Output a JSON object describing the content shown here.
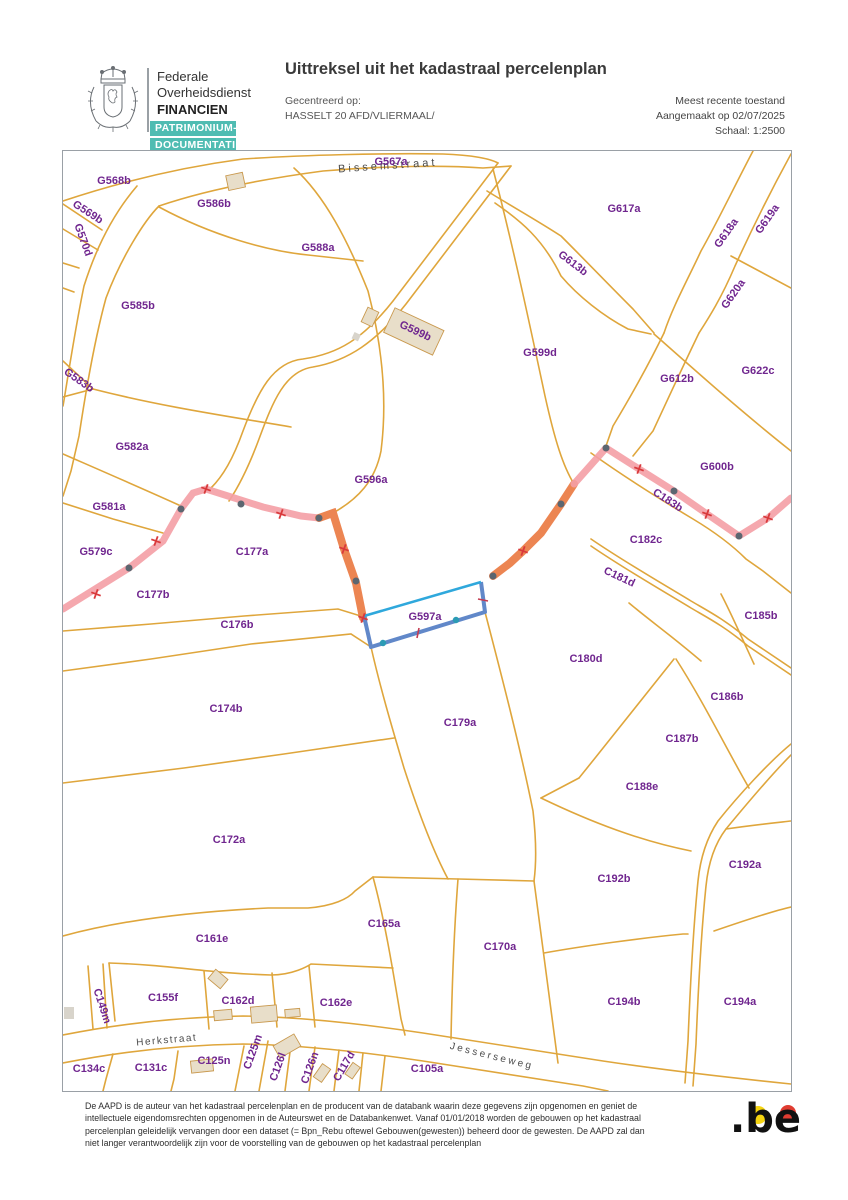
{
  "header": {
    "org_line1": "Federale",
    "org_line2": "Overheidsdienst",
    "org_line3": "FINANCIEN",
    "badge_line1": "PATRIMONIUM-",
    "badge_line2": "DOCUMENTATIE",
    "title": "Uittreksel uit het kadastraal percelenplan",
    "centered_label": "Gecentreerd op:",
    "centered_value": "HASSELT 20 AFD/VLIERMAAL/",
    "status": "Meest recente toestand",
    "created": "Aangemaakt op 02/07/2025",
    "scale": "Schaal: 1:2500"
  },
  "map": {
    "selected_parcel": "G597a",
    "colors": {
      "parcel_line": "#dfa63c",
      "parcel_label": "#70268f",
      "municipal_boundary": "#f49fa5",
      "selected_boundary": "#ec8552",
      "highlight_top": "#2fa8dc",
      "highlight_edge": "#6188c9",
      "building_fill": "#e8dec9",
      "marker_dot": "#5c6670",
      "marker_cross": "#d93a3c"
    },
    "streets": [
      {
        "name": "Bissemstraat",
        "x": 325,
        "y": 18,
        "rot": -4,
        "fs": 11,
        "ls": 3
      },
      {
        "name": "Herkstraat",
        "x": 104,
        "y": 892,
        "rot": -5,
        "fs": 10,
        "ls": 1.5
      },
      {
        "name": "Jesserseweg",
        "x": 428,
        "y": 908,
        "rot": 14,
        "fs": 10,
        "ls": 2.5
      }
    ],
    "parcels": [
      {
        "id": "G567a",
        "x": 328,
        "y": 14,
        "rot": 0
      },
      {
        "id": "G568b",
        "x": 51,
        "y": 33,
        "rot": 0
      },
      {
        "id": "G569b",
        "x": 23,
        "y": 64,
        "rot": 33
      },
      {
        "id": "G570d",
        "x": 17,
        "y": 90,
        "rot": 70
      },
      {
        "id": "G586b",
        "x": 151,
        "y": 56,
        "rot": 0
      },
      {
        "id": "G588a",
        "x": 255,
        "y": 100,
        "rot": 0
      },
      {
        "id": "G585b",
        "x": 75,
        "y": 158,
        "rot": 0
      },
      {
        "id": "G617a",
        "x": 561,
        "y": 61,
        "rot": 0
      },
      {
        "id": "G613b",
        "x": 508,
        "y": 115,
        "rot": 37
      },
      {
        "id": "G618a",
        "x": 666,
        "y": 84,
        "rot": -55
      },
      {
        "id": "G619a",
        "x": 707,
        "y": 70,
        "rot": -55
      },
      {
        "id": "G620a",
        "x": 673,
        "y": 145,
        "rot": -55
      },
      {
        "id": "G599b",
        "x": 351,
        "y": 183,
        "rot": 25
      },
      {
        "id": "G599d",
        "x": 477,
        "y": 205,
        "rot": 0
      },
      {
        "id": "G612b",
        "x": 614,
        "y": 231,
        "rot": 0
      },
      {
        "id": "G622c",
        "x": 695,
        "y": 223,
        "rot": 0
      },
      {
        "id": "G583b",
        "x": 14,
        "y": 232,
        "rot": 35
      },
      {
        "id": "G582a",
        "x": 69,
        "y": 299,
        "rot": 0
      },
      {
        "id": "G596a",
        "x": 308,
        "y": 332,
        "rot": 0
      },
      {
        "id": "G600b",
        "x": 654,
        "y": 319,
        "rot": 0
      },
      {
        "id": "C183b",
        "x": 603,
        "y": 352,
        "rot": 33
      },
      {
        "id": "G581a",
        "x": 46,
        "y": 359,
        "rot": 0
      },
      {
        "id": "C182c",
        "x": 583,
        "y": 392,
        "rot": 0
      },
      {
        "id": "G579c",
        "x": 33,
        "y": 404,
        "rot": 0
      },
      {
        "id": "C177a",
        "x": 189,
        "y": 404,
        "rot": 0
      },
      {
        "id": "C181d",
        "x": 555,
        "y": 429,
        "rot": 25
      },
      {
        "id": "C177b",
        "x": 90,
        "y": 447,
        "rot": 0
      },
      {
        "id": "C185b",
        "x": 698,
        "y": 468,
        "rot": 0
      },
      {
        "id": "G597a",
        "x": 362,
        "y": 469,
        "rot": 0
      },
      {
        "id": "C176b",
        "x": 174,
        "y": 477,
        "rot": 0
      },
      {
        "id": "C180d",
        "x": 523,
        "y": 511,
        "rot": 0
      },
      {
        "id": "C186b",
        "x": 664,
        "y": 549,
        "rot": 0
      },
      {
        "id": "C174b",
        "x": 163,
        "y": 561,
        "rot": 0
      },
      {
        "id": "C179a",
        "x": 397,
        "y": 575,
        "rot": 0
      },
      {
        "id": "C187b",
        "x": 619,
        "y": 591,
        "rot": 0
      },
      {
        "id": "C188e",
        "x": 579,
        "y": 639,
        "rot": 0
      },
      {
        "id": "C172a",
        "x": 166,
        "y": 692,
        "rot": 0
      },
      {
        "id": "C192b",
        "x": 551,
        "y": 731,
        "rot": 0
      },
      {
        "id": "C192a",
        "x": 682,
        "y": 717,
        "rot": 0
      },
      {
        "id": "C165a",
        "x": 321,
        "y": 776,
        "rot": 0
      },
      {
        "id": "C161e",
        "x": 149,
        "y": 791,
        "rot": 0
      },
      {
        "id": "C170a",
        "x": 437,
        "y": 799,
        "rot": 0
      },
      {
        "id": "C155f",
        "x": 100,
        "y": 850,
        "rot": 0
      },
      {
        "id": "C162d",
        "x": 175,
        "y": 853,
        "rot": 0
      },
      {
        "id": "C162e",
        "x": 273,
        "y": 855,
        "rot": 0
      },
      {
        "id": "C149m",
        "x": 36,
        "y": 856,
        "rot": 72
      },
      {
        "id": "C194b",
        "x": 561,
        "y": 854,
        "rot": 0
      },
      {
        "id": "C194a",
        "x": 677,
        "y": 854,
        "rot": 0
      },
      {
        "id": "C134c",
        "x": 26,
        "y": 921,
        "rot": 0
      },
      {
        "id": "C131c",
        "x": 88,
        "y": 920,
        "rot": 0
      },
      {
        "id": "C125n",
        "x": 151,
        "y": 913,
        "rot": 0
      },
      {
        "id": "C125m",
        "x": 193,
        "y": 902,
        "rot": -70
      },
      {
        "id": "C126l",
        "x": 218,
        "y": 917,
        "rot": -70
      },
      {
        "id": "C126n",
        "x": 250,
        "y": 918,
        "rot": -70
      },
      {
        "id": "C117d",
        "x": 284,
        "y": 917,
        "rot": -60
      },
      {
        "id": "C105a",
        "x": 364,
        "y": 921,
        "rot": 0
      }
    ]
  },
  "footer": {
    "disclaimer": "De AAPD is de auteur van het kadastraal percelenplan en de producent van de databank waarin deze gegevens zijn opgenomen en geniet de intellectuele eigendomsrechten opgenomen in de Auteurswet en de Databankenwet. Vanaf 01/01/2018 worden de gebouwen op het kadastraal percelenplan geleidelijk vervangen door een dataset (= Bpn_Rebu oftewel Gebouwen(gewesten)) beheerd door de gewesten. De AAPD zal dan niet langer verantwoordelijk zijn voor de voorstelling van de gebouwen op het kadastraal percelenplan",
    "be_logo": ".be"
  }
}
